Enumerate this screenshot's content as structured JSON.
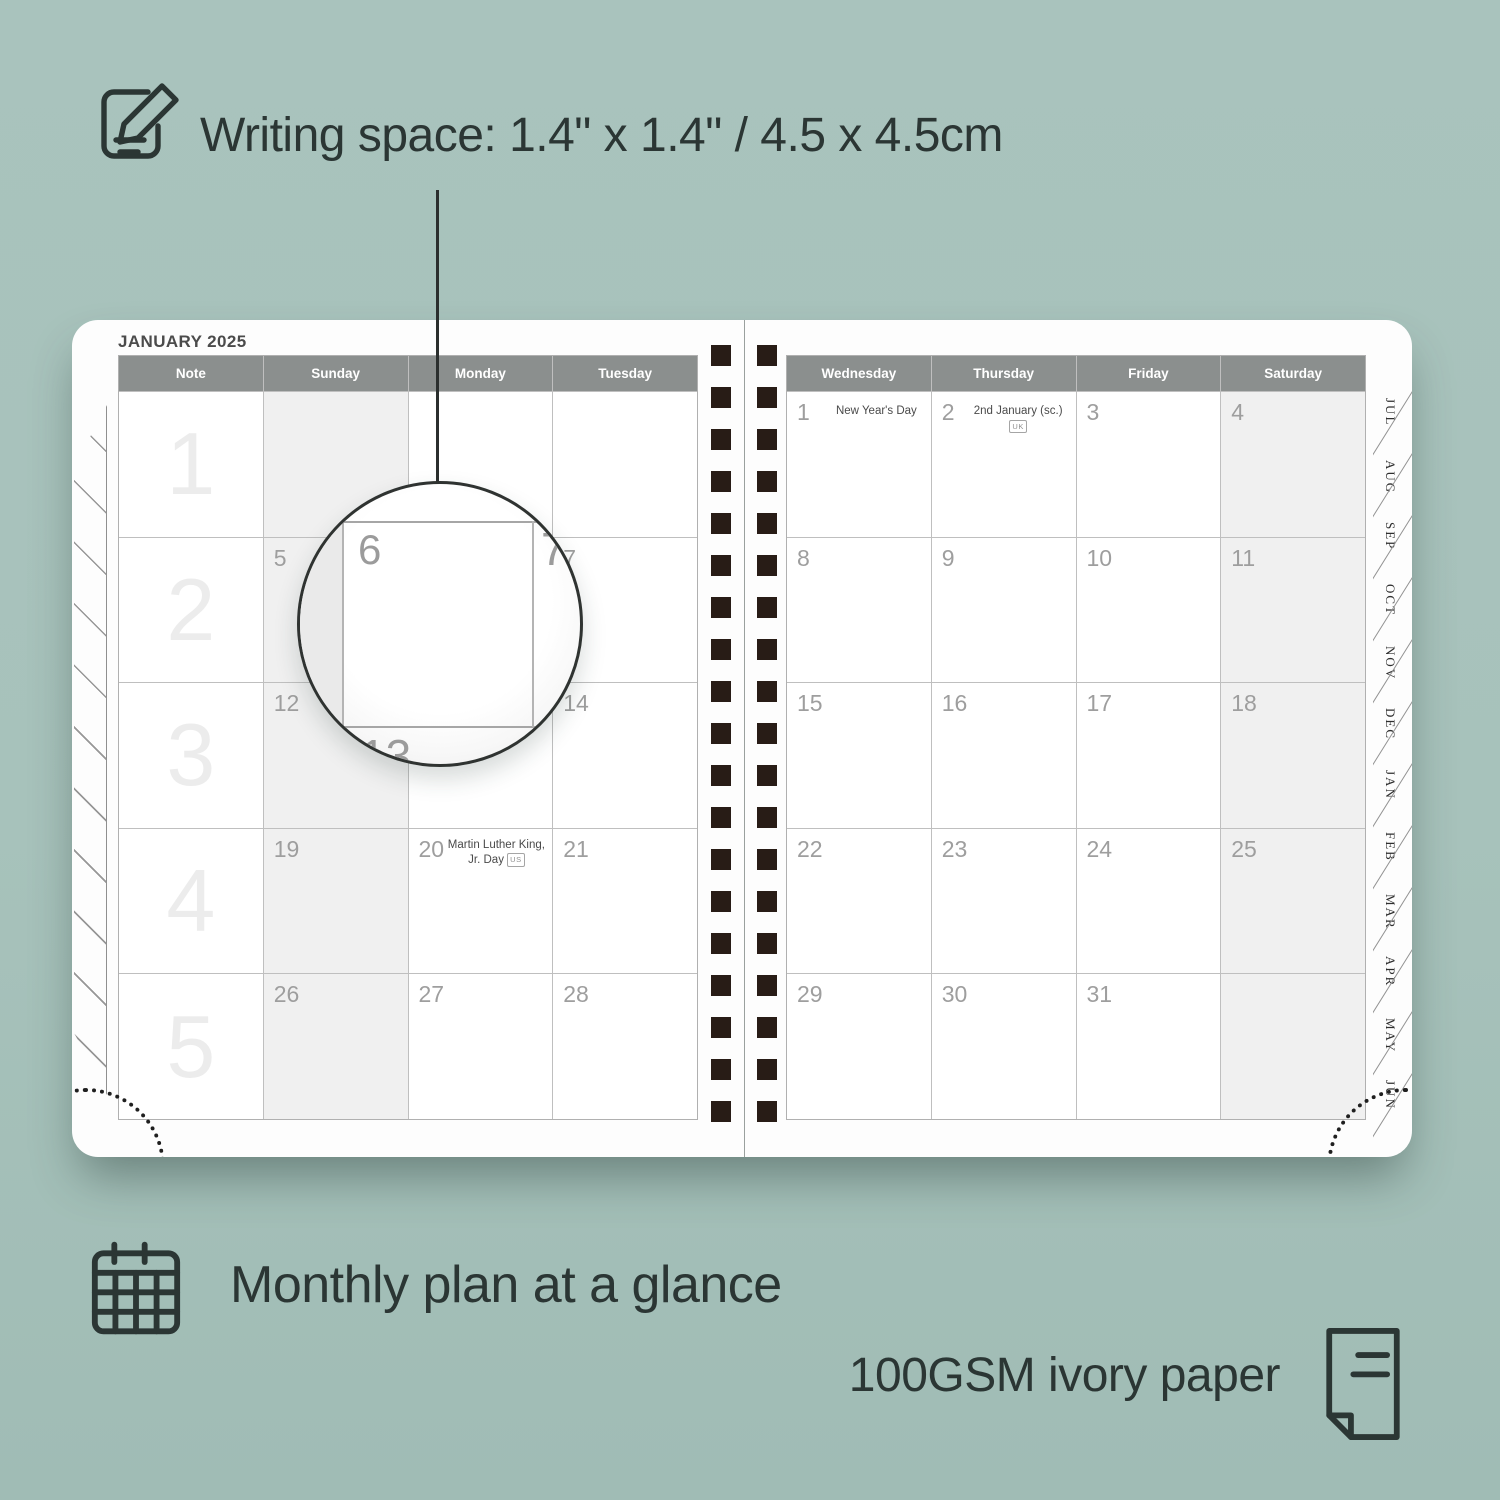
{
  "colors": {
    "background": "#a7c2bb",
    "ink": "#2b3634",
    "header_bar": "#8b8f8e",
    "weekend_shade": "#f0f0f0",
    "binding_hole": "#281c16"
  },
  "captions": {
    "writing_space": "Writing space: 1.4\" x 1.4\" / 4.5 x 4.5cm",
    "monthly_plan": "Monthly plan at a glance",
    "paper": "100GSM ivory paper"
  },
  "planner": {
    "title": "JANUARY 2025",
    "tabs": [
      "JUL",
      "AUG",
      "SEP",
      "OCT",
      "NOV",
      "DEC",
      "JAN",
      "FEB",
      "MAR",
      "APR",
      "MAY",
      "JUN"
    ],
    "left_grid": {
      "headers": [
        "Note",
        "Sunday",
        "Monday",
        "Tuesday"
      ],
      "rows": [
        {
          "week": "1",
          "cells": [
            {
              "day": ""
            },
            {
              "day": ""
            },
            {
              "day": ""
            }
          ]
        },
        {
          "week": "2",
          "cells": [
            {
              "day": "5"
            },
            {
              "day": "6"
            },
            {
              "day": "7"
            }
          ]
        },
        {
          "week": "3",
          "cells": [
            {
              "day": "12"
            },
            {
              "day": "13"
            },
            {
              "day": "14"
            }
          ]
        },
        {
          "week": "4",
          "cells": [
            {
              "day": "19"
            },
            {
              "day": "20",
              "holiday": "Martin Luther King, Jr. Day",
              "badge": "US"
            },
            {
              "day": "21"
            }
          ]
        },
        {
          "week": "5",
          "cells": [
            {
              "day": "26"
            },
            {
              "day": "27"
            },
            {
              "day": "28"
            }
          ]
        }
      ]
    },
    "right_grid": {
      "headers": [
        "Wednesday",
        "Thursday",
        "Friday",
        "Saturday"
      ],
      "rows": [
        {
          "cells": [
            {
              "day": "1",
              "holiday": "New Year's Day"
            },
            {
              "day": "2",
              "holiday": "2nd January (sc.)",
              "badge": "UK"
            },
            {
              "day": "3"
            },
            {
              "day": "4"
            }
          ]
        },
        {
          "cells": [
            {
              "day": "8"
            },
            {
              "day": "9"
            },
            {
              "day": "10"
            },
            {
              "day": "11"
            }
          ]
        },
        {
          "cells": [
            {
              "day": "15"
            },
            {
              "day": "16"
            },
            {
              "day": "17"
            },
            {
              "day": "18"
            }
          ]
        },
        {
          "cells": [
            {
              "day": "22"
            },
            {
              "day": "23"
            },
            {
              "day": "24"
            },
            {
              "day": "25"
            }
          ]
        },
        {
          "cells": [
            {
              "day": "29"
            },
            {
              "day": "30"
            },
            {
              "day": "31"
            },
            {
              "day": ""
            }
          ]
        }
      ]
    },
    "magnifier": {
      "day": "6",
      "next_day": "7",
      "below_day": "13"
    }
  }
}
